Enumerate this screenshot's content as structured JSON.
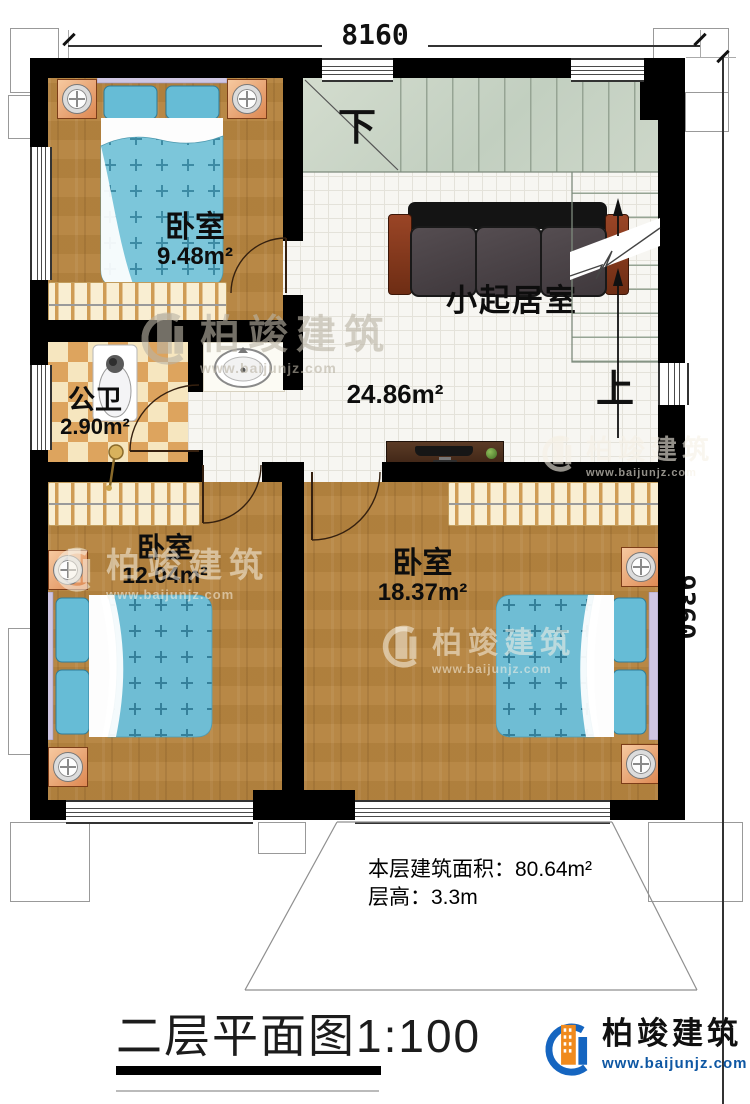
{
  "dimensions": {
    "width_top": "8160",
    "height_right": "9360"
  },
  "rooms": [
    {
      "name": "卧室",
      "area": "9.48m²"
    },
    {
      "name": "公卫",
      "area": "2.90m²"
    },
    {
      "name": "小起居室",
      "area": "24.86m²"
    },
    {
      "name": "卧室",
      "area": "12.04m²"
    },
    {
      "name": "卧室",
      "area": "18.37m²"
    }
  ],
  "stairs": {
    "down_label": "下",
    "up_label": "上"
  },
  "notes": {
    "floor_area": "本层建筑面积：80.64m²",
    "floor_height": "层高：3.3m"
  },
  "title": "二层平面图1:100",
  "brand": {
    "name": "柏竣建筑",
    "url": "www.baijunjz.com"
  },
  "watermark": {
    "name": "柏竣建筑",
    "url": "www.baijunjz.com"
  }
}
